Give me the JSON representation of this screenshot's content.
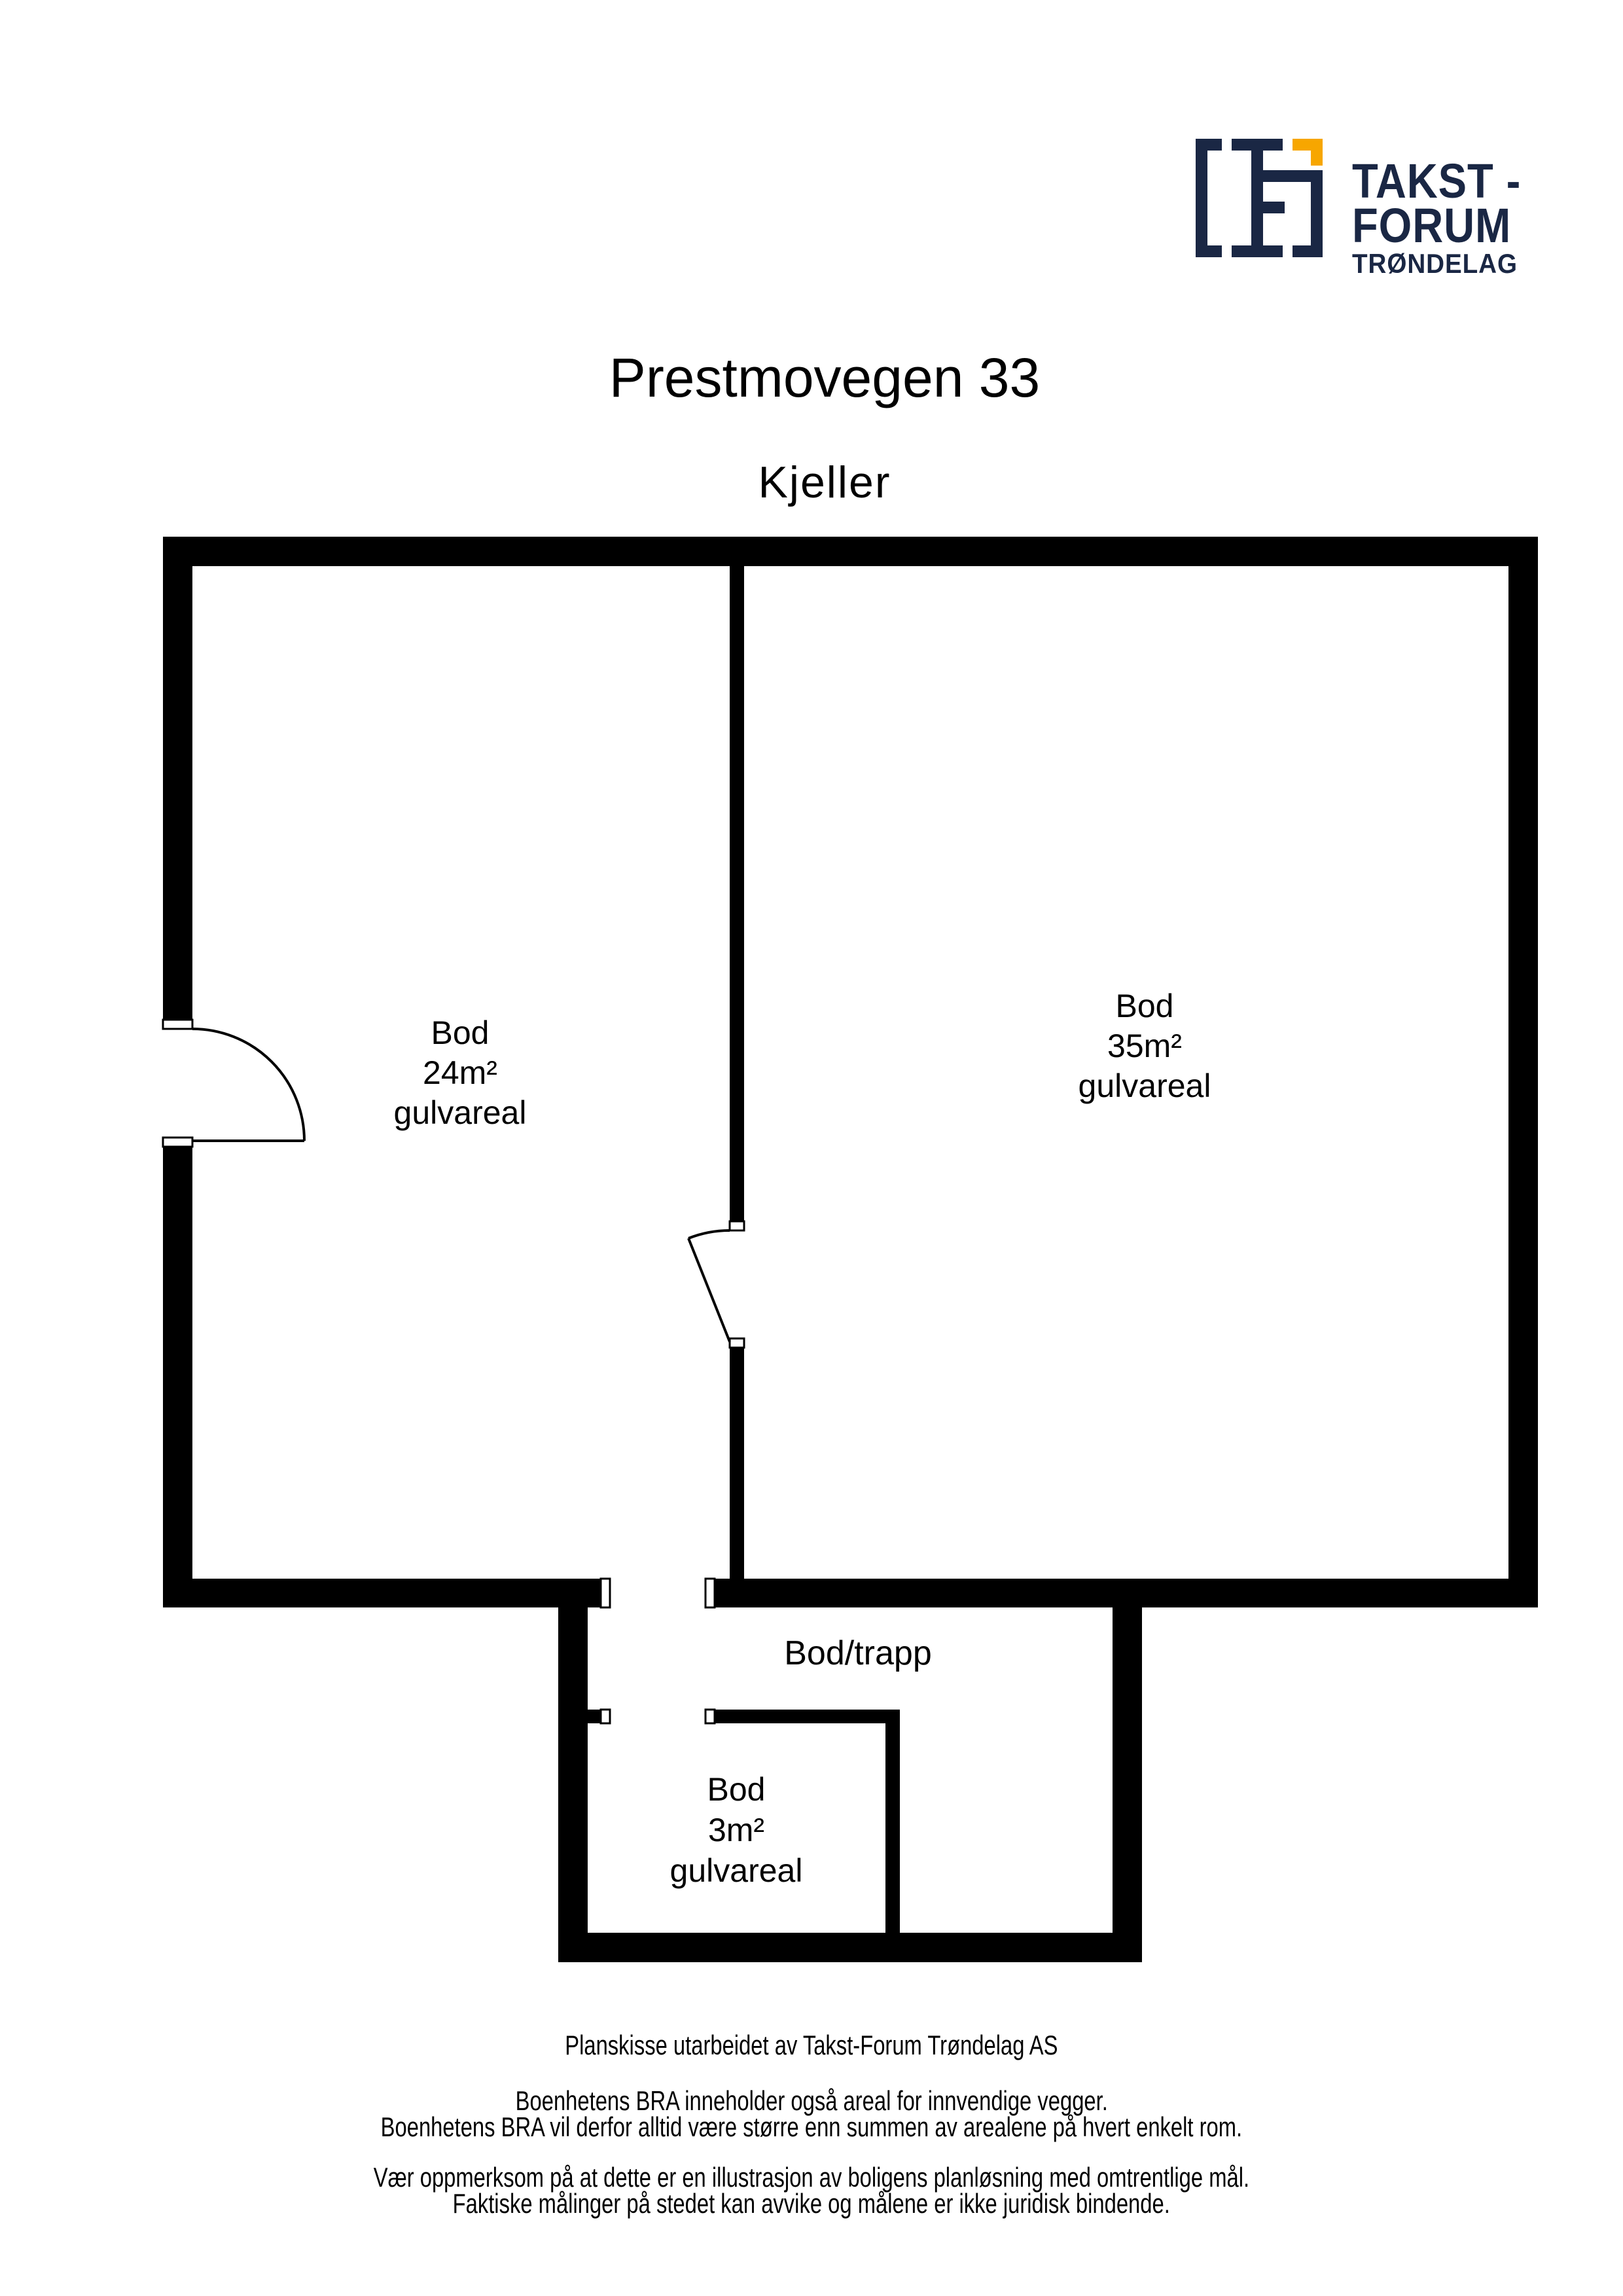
{
  "page": {
    "background": "#FFFFFF",
    "ink": "#000000"
  },
  "logo": {
    "line1": "TAKST -",
    "line2": "FORUM",
    "line3": "TRØNDELAG",
    "colors": {
      "navy": "#1A2744",
      "yellow": "#F7A600"
    },
    "icon": "takst-forum-floorplan-monogram"
  },
  "header": {
    "title": "Prestmovegen 33",
    "subtitle": "Kjeller"
  },
  "rooms": [
    {
      "id": "bod24",
      "name": "Bod",
      "area": "24m²",
      "detail": "gulvareal"
    },
    {
      "id": "bod35",
      "name": "Bod",
      "area": "35m²",
      "detail": "gulvareal"
    },
    {
      "id": "bodtrapp",
      "name": "Bod/trapp",
      "area": "",
      "detail": ""
    },
    {
      "id": "bod3",
      "name": "Bod",
      "area": "3m²",
      "detail": "gulvareal"
    }
  ],
  "footer": {
    "credit": "Planskisse utarbeidet av Takst-Forum Trøndelag AS",
    "bra_note_1": "Boenhetens BRA inneholder også areal for innvendige vegger.",
    "bra_note_2": "Boenhetens BRA vil derfor alltid være større enn summen av arealene på hvert enkelt rom.",
    "disclaimer_1": "Vær oppmerksom på at dette er en illustrasjon av boligens planløsning med omtrentlige mål.",
    "disclaimer_2": "Faktiske målinger på stedet kan avvike og målene er ikke juridisk bindende."
  }
}
